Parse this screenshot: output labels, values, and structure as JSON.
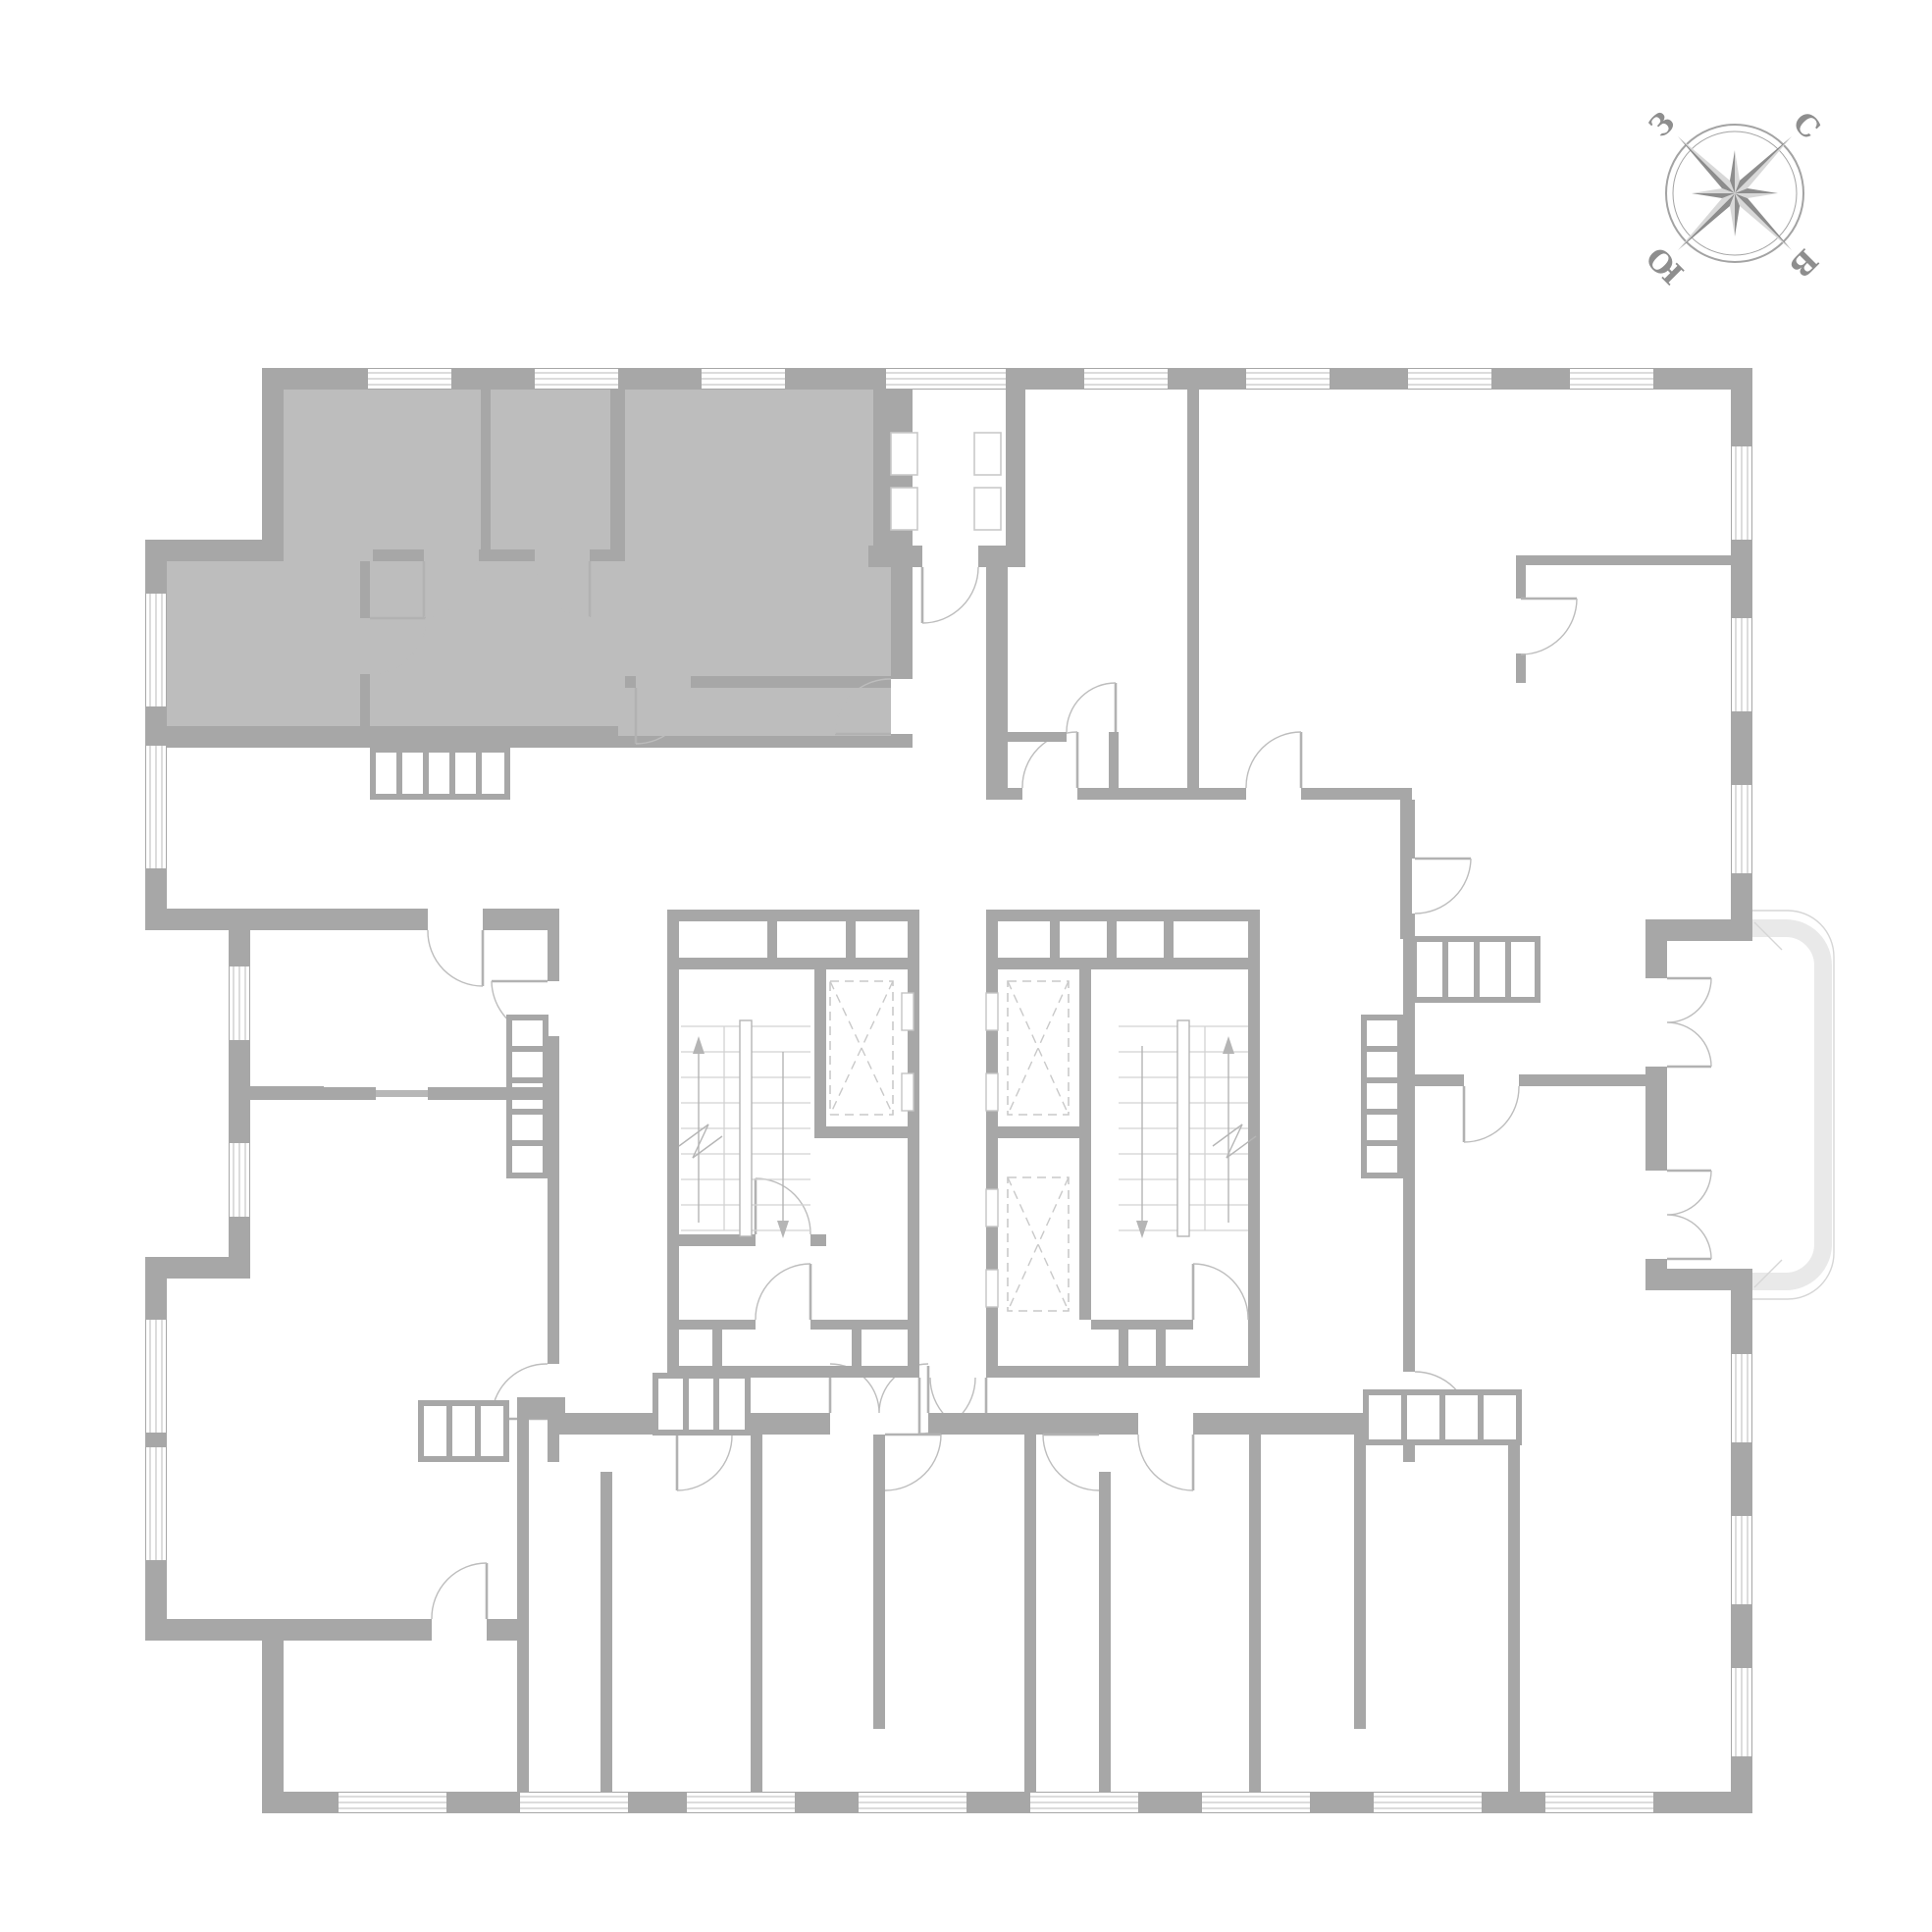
{
  "compass": {
    "north": "С",
    "east": "В",
    "south": "Ю",
    "west": "З"
  },
  "plan": {
    "highlighted_apartments": 1,
    "stairwells": 2,
    "elevator_shafts": 3,
    "balconies": 1,
    "loggias": 1
  },
  "colors": {
    "background": "#ffffff",
    "walls": "#a7a7a7",
    "highlighted_apartment_fill": "#bdbdbd",
    "door_arcs": "#bdbdbd",
    "balcony_slab": "#e9e9e9",
    "stair_treads": "#d2d2d2",
    "elevator_dashes": "#c9c9c9",
    "compass_dark": "#8d8d8d",
    "compass_light": "#d8d8d8"
  }
}
